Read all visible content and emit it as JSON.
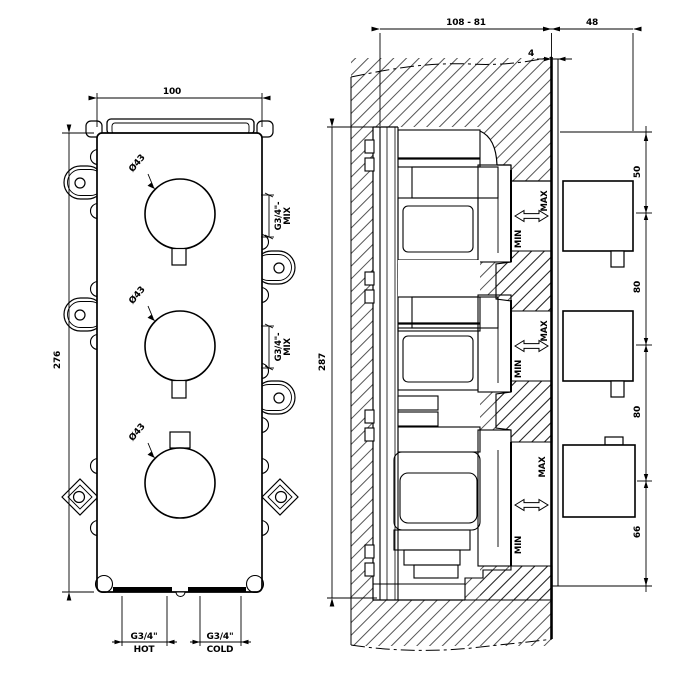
{
  "front_view": {
    "width": "100",
    "height": "276",
    "knobs": [
      {
        "dia": "Ø43"
      },
      {
        "dia": "Ø43"
      },
      {
        "dia": "Ø43"
      }
    ],
    "mix_ports": [
      {
        "size": "G3/4\"-",
        "label": "MIX"
      },
      {
        "size": "G3/4\"-",
        "label": "MIX"
      }
    ],
    "inlets": [
      {
        "size": "G3/4\"",
        "label": "HOT"
      },
      {
        "size": "G3/4\"",
        "label": "COLD"
      }
    ]
  },
  "section_view": {
    "depth_range": "108 - 81",
    "handle_depth": "48",
    "face_offset": "4",
    "body_height": "287",
    "spacings": [
      "50",
      "80",
      "80",
      "66"
    ],
    "adjust_labels": [
      {
        "min": "MIN",
        "max": "MAX"
      },
      {
        "min": "MIN",
        "max": "MAX"
      },
      {
        "min": "MIN",
        "max": "MAX"
      }
    ]
  }
}
